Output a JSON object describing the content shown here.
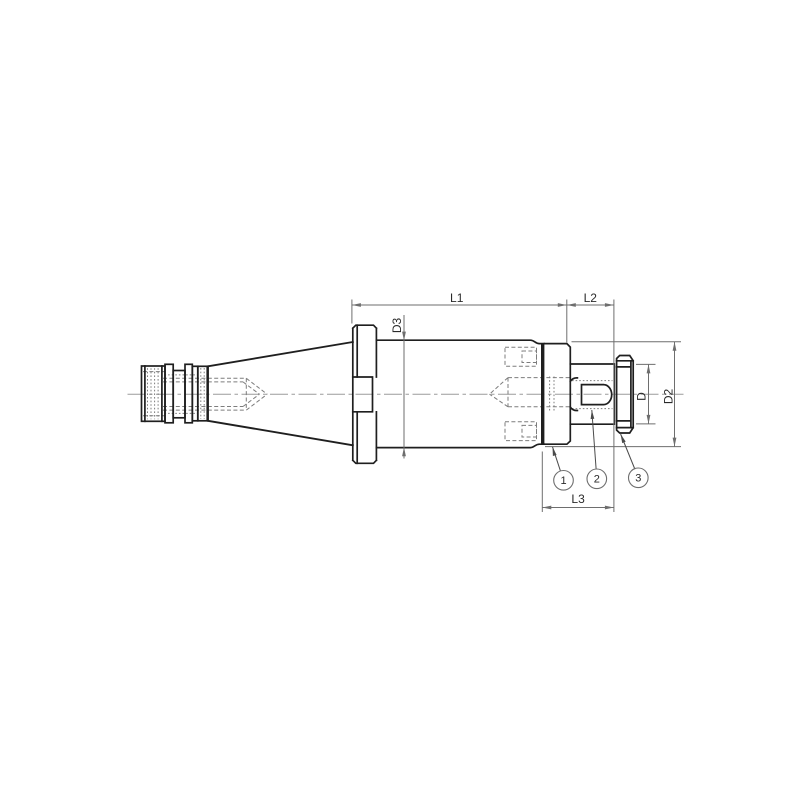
{
  "drawing": {
    "type": "technical-dimension-drawing",
    "subject": "threaded-milling-arbor-side-view",
    "dimension_labels": {
      "l1": "L1",
      "l2": "L2",
      "l3": "L3",
      "d3": "D3",
      "d": "D",
      "d2": "D2"
    },
    "balloon_labels": {
      "b1": "1",
      "b2": "2",
      "b3": "3"
    },
    "colors": {
      "outline": "#1f1f1f",
      "dimension": "#6e6e6e",
      "hidden": "#7d7d7d",
      "centerline": "#9b9b9b",
      "background": "#ffffff",
      "text": "#2a2a2a"
    }
  }
}
